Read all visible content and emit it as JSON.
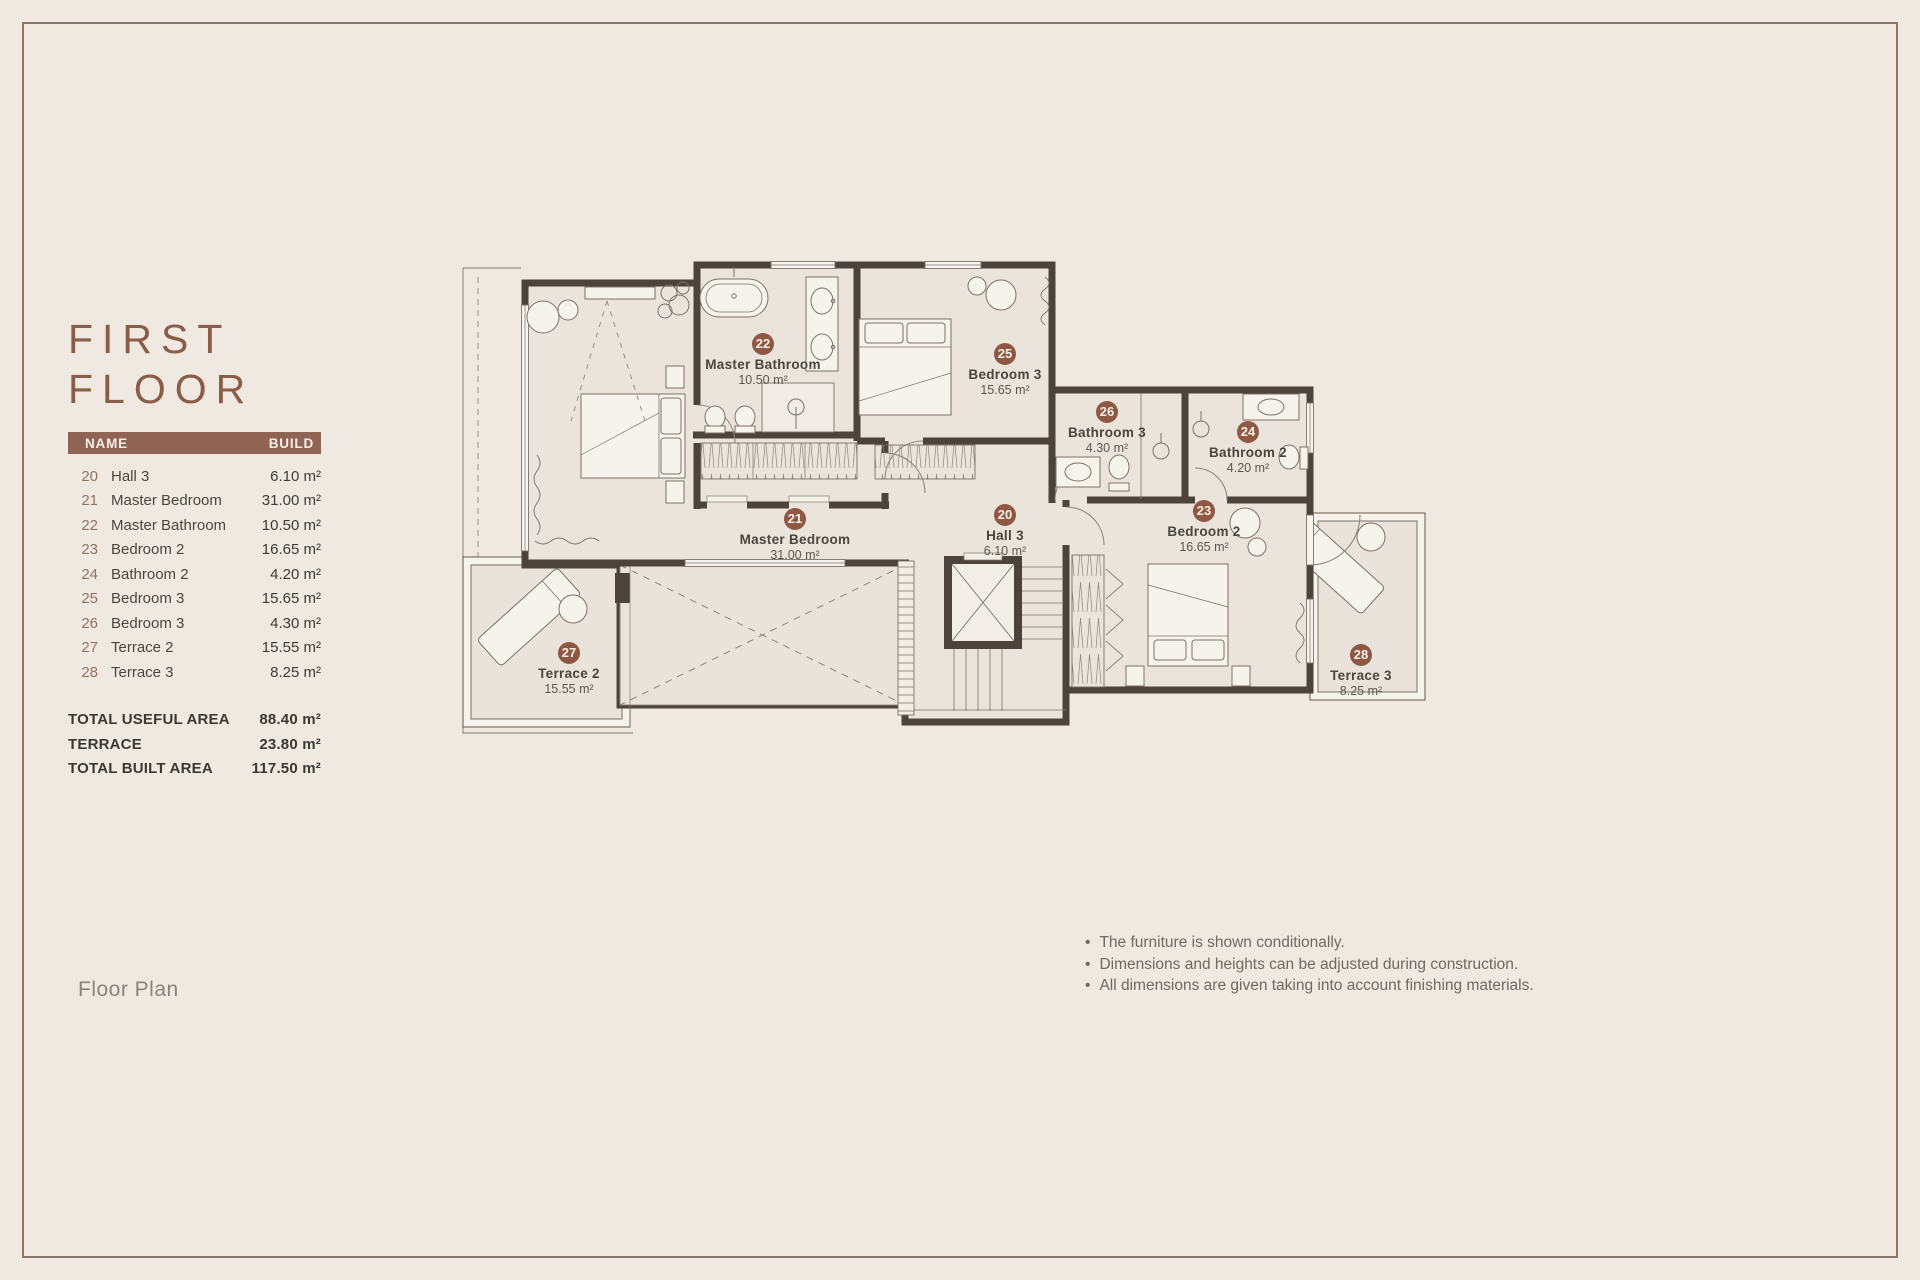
{
  "page": {
    "title_line1": "FIRST",
    "title_line2": "FLOOR",
    "caption": "Floor Plan"
  },
  "table": {
    "headers": {
      "name": "NAME",
      "build": "BUILD"
    },
    "rows": [
      {
        "num": "20",
        "name": "Hall 3",
        "value": "6.10 m²"
      },
      {
        "num": "21",
        "name": "Master Bedroom",
        "value": "31.00 m²"
      },
      {
        "num": "22",
        "name": "Master Bathroom",
        "value": "10.50 m²"
      },
      {
        "num": "23",
        "name": "Bedroom 2",
        "value": "16.65 m²"
      },
      {
        "num": "24",
        "name": "Bathroom 2",
        "value": "4.20 m²"
      },
      {
        "num": "25",
        "name": "Bedroom 3",
        "value": "15.65 m²"
      },
      {
        "num": "26",
        "name": "Bedroom 3",
        "value": "4.30 m²"
      },
      {
        "num": "27",
        "name": "Terrace 2",
        "value": "15.55 m²"
      },
      {
        "num": "28",
        "name": "Terrace 3",
        "value": "8.25 m²"
      }
    ],
    "totals": [
      {
        "label": "TOTAL USEFUL AREA",
        "value": "88.40 m²"
      },
      {
        "label": "TERRACE",
        "value": "23.80 m²"
      },
      {
        "label": "TOTAL BUILT AREA",
        "value": "117.50 m²"
      }
    ]
  },
  "plan": {
    "rooms": [
      {
        "num": "20",
        "name": "Hall 3",
        "area": "6.10 m²",
        "x": 550,
        "y": 260
      },
      {
        "num": "21",
        "name": "Master Bedroom",
        "area": "31.00 m²",
        "x": 340,
        "y": 264
      },
      {
        "num": "22",
        "name": "Master Bathroom",
        "area": "10.50 m²",
        "x": 308,
        "y": 89
      },
      {
        "num": "23",
        "name": "Bedroom 2",
        "area": "16.65 m²",
        "x": 749,
        "y": 256
      },
      {
        "num": "24",
        "name": "Bathroom 2",
        "area": "4.20 m²",
        "x": 793,
        "y": 177
      },
      {
        "num": "25",
        "name": "Bedroom 3",
        "area": "15.65 m²",
        "x": 550,
        "y": 99
      },
      {
        "num": "26",
        "name": "Bathroom 3",
        "area": "4.30 m²",
        "x": 652,
        "y": 157
      },
      {
        "num": "27",
        "name": "Terrace 2",
        "area": "15.55 m²",
        "x": 114,
        "y": 398
      },
      {
        "num": "28",
        "name": "Terrace 3",
        "area": "8.25 m²",
        "x": 906,
        "y": 400
      }
    ]
  },
  "notes": [
    "The furniture is shown conditionally.",
    "Dimensions and heights can be adjusted during construction.",
    "All dimensions are given taking into account finishing materials."
  ],
  "colors": {
    "accent": "#8E5843",
    "wall": "#4C443C",
    "header_bar": "#8F6452",
    "background": "#EFE9E2"
  }
}
